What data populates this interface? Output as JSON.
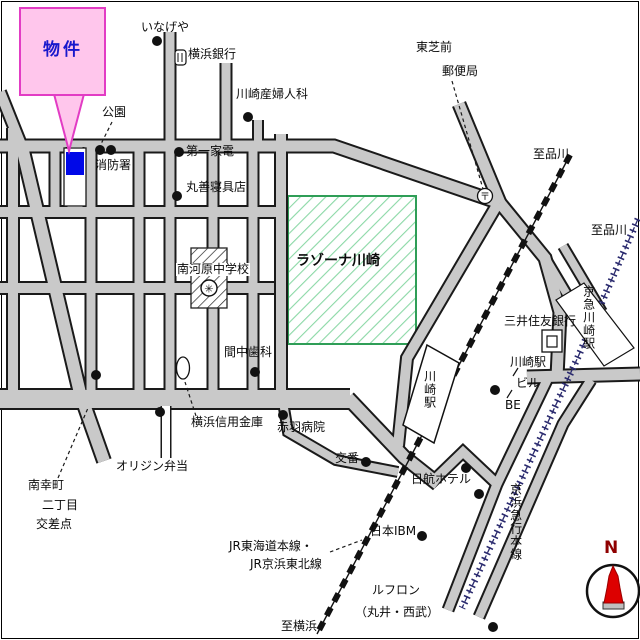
{
  "callout": {
    "label": "物件"
  },
  "labels": [
    {
      "id": "inageya",
      "text": "いなげや"
    },
    {
      "id": "yokohama-bank",
      "text": "横浜銀行"
    },
    {
      "id": "sanfujinka",
      "text": "川崎産婦人科"
    },
    {
      "id": "toshiba-mae",
      "text": "東芝前"
    },
    {
      "id": "yubinkyoku",
      "text": "郵便局"
    },
    {
      "id": "to-shinagawa-jr",
      "text": "至品川"
    },
    {
      "id": "to-shinagawa-keikyu",
      "text": "至品川"
    },
    {
      "id": "kouen",
      "text": "公園"
    },
    {
      "id": "shobosho",
      "text": "消防署"
    },
    {
      "id": "daiichi-kaden",
      "text": "第一家電"
    },
    {
      "id": "maruzen",
      "text": "丸善寝具店"
    },
    {
      "id": "lazona",
      "text": "ラゾーナ川崎"
    },
    {
      "id": "minamikawara-school",
      "text": "南河原中学校"
    },
    {
      "id": "manaka-dental",
      "text": "間中歯科"
    },
    {
      "id": "yokohama-shinkin",
      "text": "横浜信用金庫"
    },
    {
      "id": "akabane-hospital",
      "text": "赤羽病院"
    },
    {
      "id": "origin-bento",
      "text": "オリジン弁当"
    },
    {
      "id": "minamisaiwai",
      "text": "南幸町"
    },
    {
      "id": "nichome",
      "text": "二丁目"
    },
    {
      "id": "kosaten",
      "text": "交差点"
    },
    {
      "id": "koban",
      "text": "交番"
    },
    {
      "id": "nikko-hotel",
      "text": "日航ホテル"
    },
    {
      "id": "nihon-ibm",
      "text": "日本IBM"
    },
    {
      "id": "jr-tokaido",
      "text": "JR東海道本線・"
    },
    {
      "id": "jr-keihintohoku",
      "text": "JR京浜東北線"
    },
    {
      "id": "to-yokohama",
      "text": "至横浜"
    },
    {
      "id": "lefront",
      "text": "ルフロン"
    },
    {
      "id": "lefront-sub",
      "text": "（丸井・西武）"
    },
    {
      "id": "mitsui-sumitomo-bank",
      "text": "三井住友銀行"
    },
    {
      "id": "keikyu-kawasaki-sta",
      "text": "京急川崎駅"
    },
    {
      "id": "kawasaki-sta-bldg",
      "text": "川崎駅"
    },
    {
      "id": "bldg-biru",
      "text": "ビル"
    },
    {
      "id": "bldg-be",
      "text": "BE"
    },
    {
      "id": "jr-kawasaki-sta",
      "text": "川崎駅"
    },
    {
      "id": "keihin-kyuko-line",
      "text": "京浜急行本線"
    }
  ],
  "icons": {
    "postal_symbol": "〒",
    "school_symbol": "✳"
  },
  "compass": {
    "north": "N"
  },
  "colors": {
    "road_fill": "#c9c9c9",
    "road_casing": "#1a1a1a",
    "green_area_border": "#2f9e57",
    "green_area_hatch": "#8bd8a6",
    "callout_fill": "#ffc6ec",
    "callout_border": "#e23cc4",
    "property_marker": "#0008e8",
    "callout_text": "#1818cc",
    "jr_rail": "#111111",
    "keikyu_rail": "#2a2a6e",
    "compass_red": "#dd0000"
  }
}
